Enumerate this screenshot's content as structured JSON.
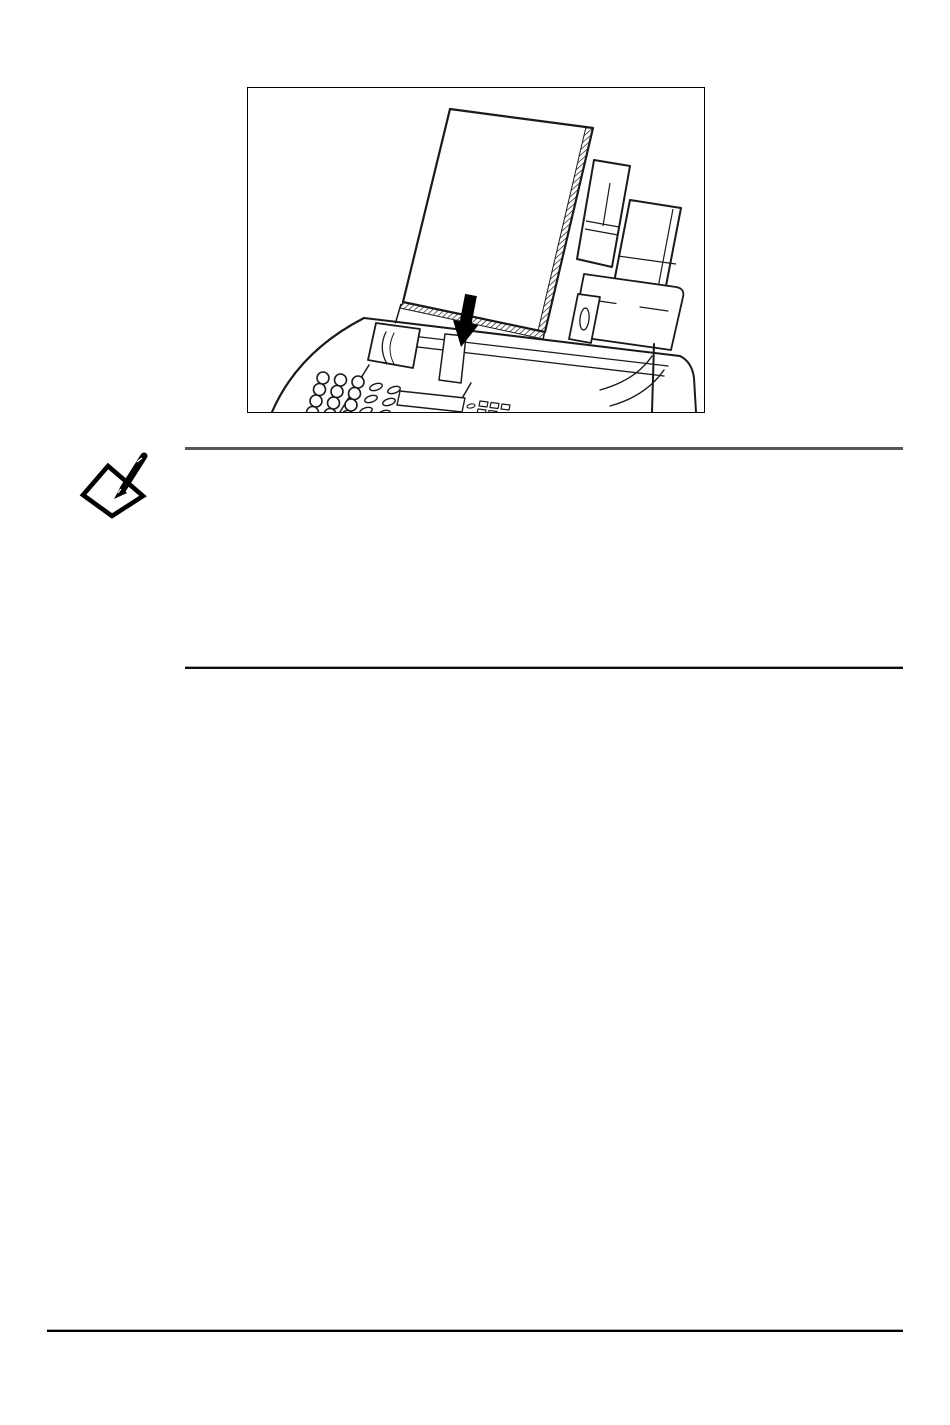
{
  "page": {
    "background_color": "#ffffff"
  },
  "figure": {
    "frame_border_color": "#000000",
    "line_color": "#1a1a1a",
    "paper_fill": "#ffffff",
    "arrow_color": "#000000"
  },
  "icons": {
    "note": "note-pencil-icon",
    "insert_arrow": "down-arrow"
  },
  "note_icon": {
    "color": "#000000"
  },
  "rules": {
    "note_top_color": "#58585b",
    "note_bottom_color": "#0d0d0d",
    "footer_color": "#000000"
  }
}
